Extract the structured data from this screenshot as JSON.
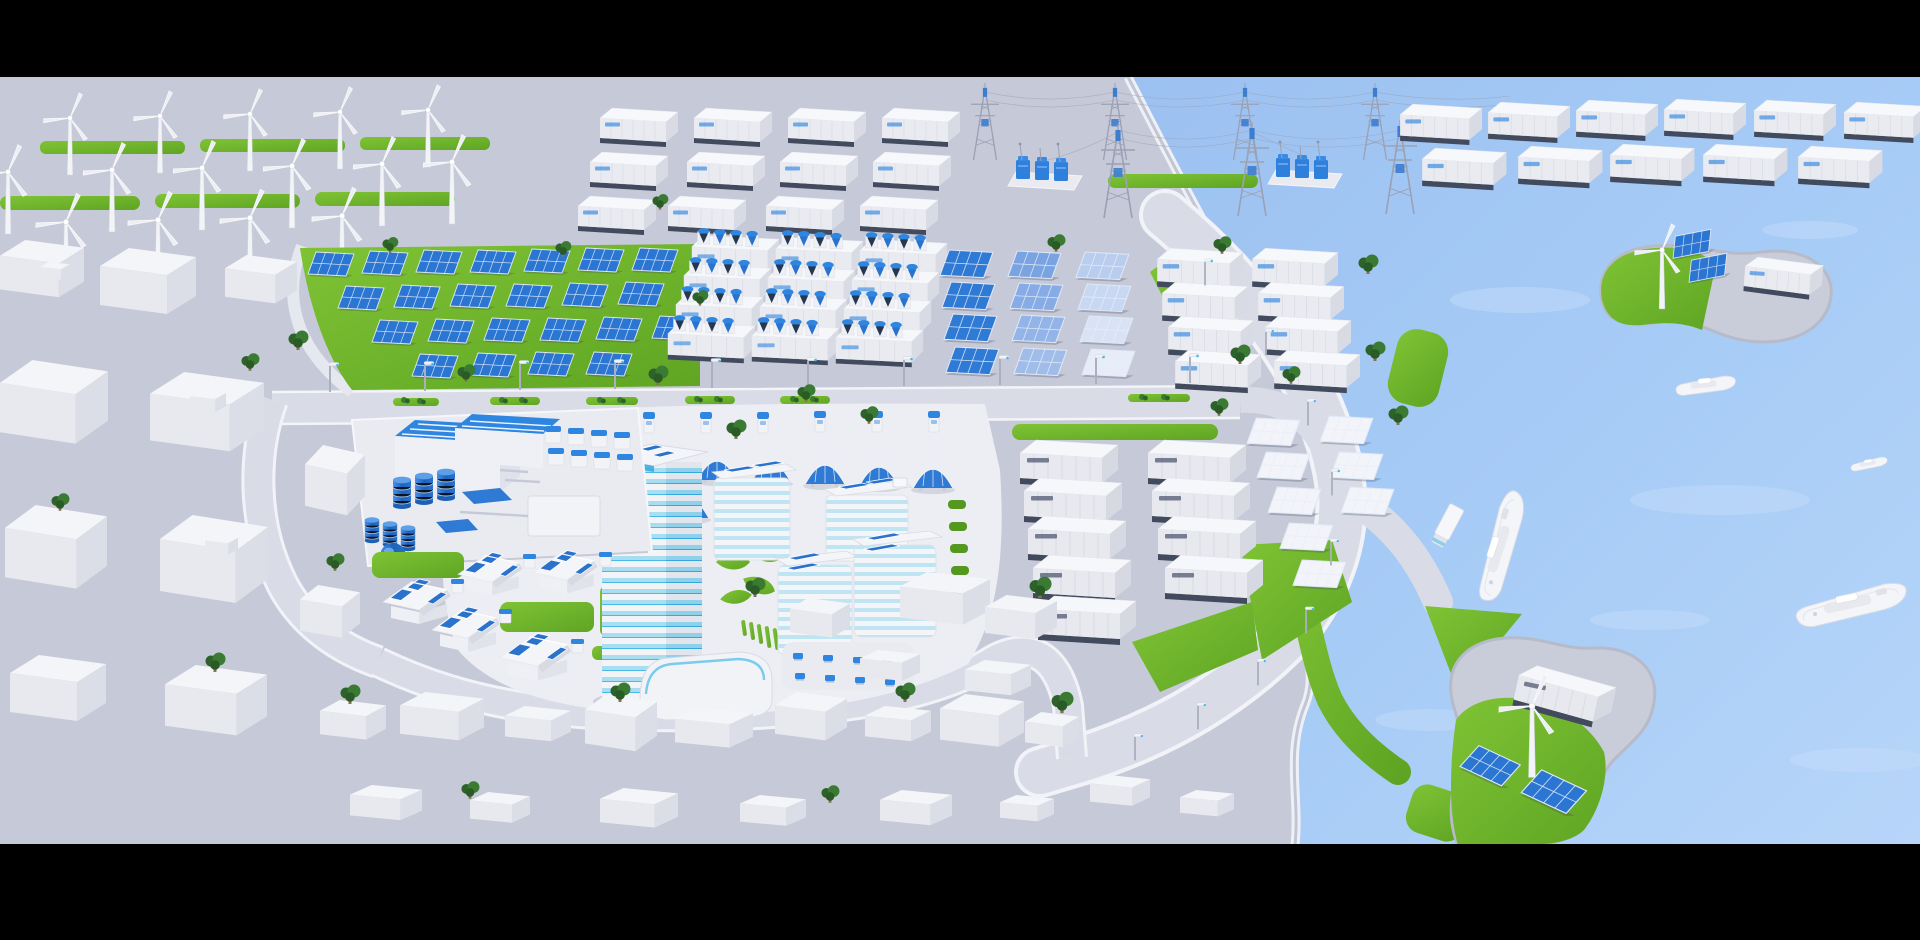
{
  "meta": {
    "description": "Isometric 3D render of a coastal smart-city renewable energy district, letterboxed with black bars",
    "canvas": {
      "width": 1920,
      "height": 940
    },
    "letterbox": {
      "top_height": 77,
      "bottom_height": 96
    }
  },
  "palette": {
    "letterbox": "#000000",
    "ground": "#c6c9d7",
    "road": "#d9dce6",
    "road_edge": "#f4f5f9",
    "plaza": "#eceef4",
    "water_deep": "#9cc1f1",
    "water_light": "#bcd8f9",
    "grass": "#6fb92c",
    "grass_dark": "#55981f",
    "panel_blue": "#2a72cc",
    "accent_blue": "#2f86e0",
    "glass_blue": "#49b9e8",
    "structure_white": "#f5f6f9",
    "structure_gray": "#dfe1e9",
    "dark_base": "#424a5e",
    "pylon_gray": "#9ba1b4",
    "tree_green": "#2e622b",
    "ship_white": "#f4f5f8"
  },
  "scene": {
    "labels": {
      "scene": "Isometric 3D render of a coastal smart-city renewable energy district",
      "wind_farm": "Wind turbine farm with green grass strips",
      "battery_yard_top": "Rows of white battery storage containers",
      "transmission": "High-voltage lattice transmission towers with transformer substations",
      "coastal_containers": "Rows of white containers curving along the coast",
      "solar_farm": "Ground-mounted blue solar farm on grass field",
      "pcs_units": "Battery inverter skid units with blue cooling fans",
      "gradient_panels": "Solar panel rows fading from blue to white",
      "storage_containers": "White storage containers beside panel rows",
      "campus": "Smart building campus with glass tower and rooftop solar panels",
      "plant": "Industrial hydrogen plant with blue tanks and sphere",
      "houses": "Residential houses with blue rooftop solar panels",
      "container_yard": "Container yard with large white units",
      "planned_panels": "Blank white solar panel rows",
      "ev_chargers": "Row of EV charging stations",
      "carports": "Arched blue solar carport canopies",
      "bay": "Light blue bay with ships",
      "island_north": "Kidney-shaped island with wind turbine, solar panels and container",
      "island_south": "Island with wind turbine, tilted solar panels and container",
      "city_left": "Untextured white city blocks, left side",
      "city_bottom": "Untextured white city blocks, bottom",
      "truck": "White box truck on waterfront road",
      "ships": "White ferries and cargo ships"
    },
    "inventory": [
      {
        "name": "wind-turbine",
        "count": 16
      },
      {
        "name": "grass-strip",
        "count": 6
      },
      {
        "name": "battery-container-small",
        "count": 12
      },
      {
        "name": "coastal-container",
        "count": 11
      },
      {
        "name": "transmission-tower",
        "count": 7
      },
      {
        "name": "transformer-substation",
        "count": 2
      },
      {
        "name": "solar-panel-blue",
        "count": 23
      },
      {
        "name": "inverter-skid",
        "count": 12
      },
      {
        "name": "solar-panel-gradient",
        "count": 12
      },
      {
        "name": "storage-container",
        "count": 8
      },
      {
        "name": "yard-container",
        "count": 9
      },
      {
        "name": "solar-panel-white",
        "count": 8
      },
      {
        "name": "ev-charger",
        "count": 7
      },
      {
        "name": "solar-carport",
        "count": 7
      },
      {
        "name": "solar-house",
        "count": 5
      },
      {
        "name": "picnic-table",
        "count": 8
      },
      {
        "name": "tree",
        "count": 30
      },
      {
        "name": "ship",
        "count": 4
      },
      {
        "name": "island",
        "count": 2
      },
      {
        "name": "truck",
        "count": 1
      }
    ]
  }
}
